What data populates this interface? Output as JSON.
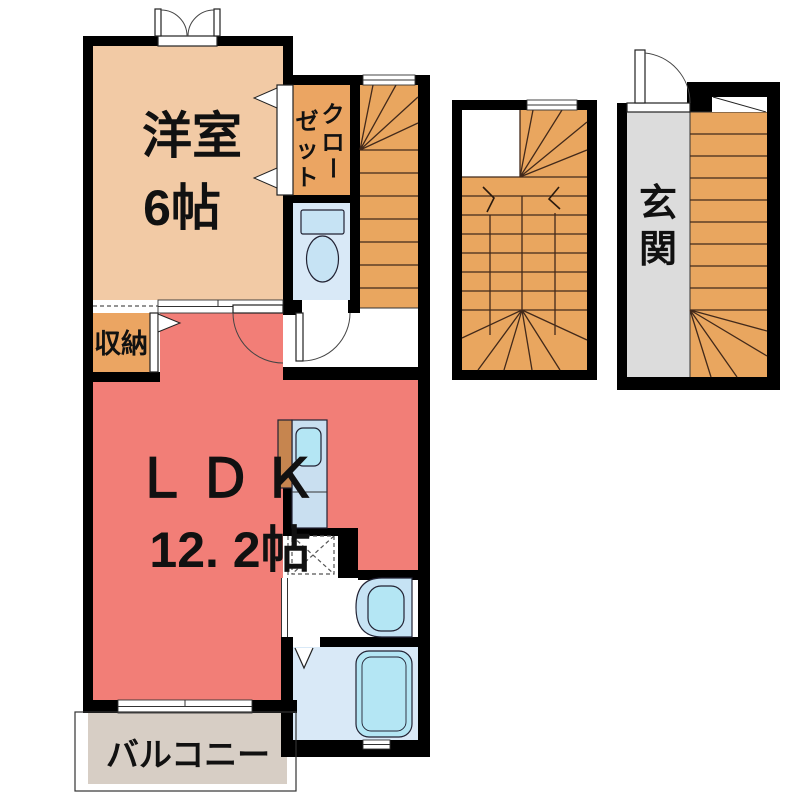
{
  "title": "apartment-floor-plan",
  "colors": {
    "wall": "#000000",
    "western_room": "#F2CAA5",
    "closet": "#EBA562",
    "storage": "#EBA562",
    "stairs": "#E9A65F",
    "ldk": "#F27E77",
    "toilet_room": "#D9E9F7",
    "bathroom": "#D9E9F7",
    "fixture_blue": "#C6E3F4",
    "fixture_cyan": "#B4E6F4",
    "counter": "#C9DFF0",
    "counter_back": "#C6854F",
    "balcony": "#D7CEC5",
    "entrance_floor": "#DCDCDC"
  },
  "rooms": {
    "western_room": {
      "name": "洋室",
      "area": "6帖"
    },
    "closet": {
      "chars": [
        "ク",
        "ロ",
        "ー",
        "ゼ",
        "ッ",
        "ト"
      ]
    },
    "storage": {
      "name": "収納"
    },
    "ldk": {
      "name": "ＬＤＫ",
      "area": "12. 2帖"
    },
    "balcony": {
      "name": "バルコニー"
    },
    "entrance": {
      "chars": [
        "玄",
        "関"
      ]
    }
  }
}
